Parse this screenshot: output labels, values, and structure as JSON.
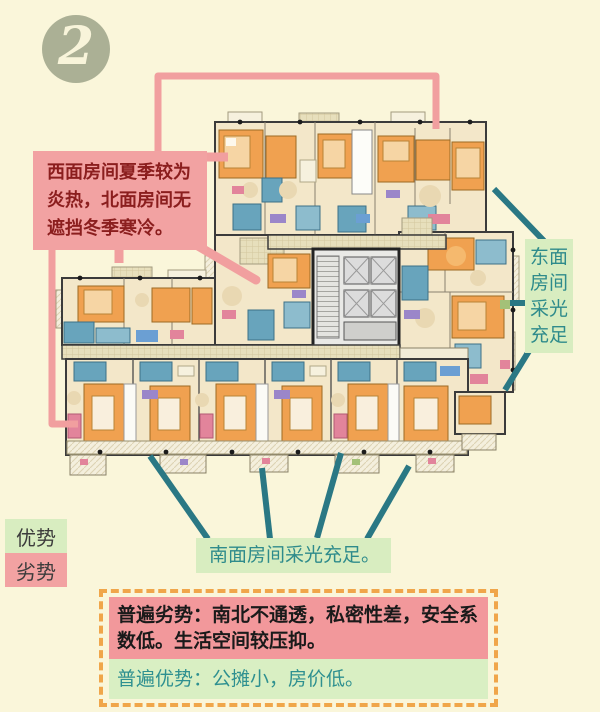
{
  "badge": {
    "number": "2"
  },
  "notes": {
    "west": "西面房间夏季较为炎热，北面房间无遮挡冬季寒冷。",
    "east": "东面房间采光充足",
    "south": "南面房间采光充足。"
  },
  "legend": {
    "advantage": "优势",
    "disadvantage": "劣势"
  },
  "summary": {
    "disadvantage": "普遍劣势：南北不通透，私密性差，安全系数低。生活空间较压抑。",
    "advantage": "普遍优势：公摊小，房价低。"
  },
  "colors": {
    "page_background": "#faf6da",
    "note_pink": "#f2a2a2",
    "note_pink_text": "#8b1e1e",
    "note_green": "#d8edc0",
    "teal_text": "#2e8b8b",
    "teal_line": "#2a7884",
    "pink_line": "#f19f9f",
    "dashed_border_orange": "#f0a64a",
    "summary_pink": "#f2989b",
    "summary_green": "#d9efc3",
    "badge_fill": "#abb095",
    "plan_orange": "#f0a150",
    "plan_cream": "#f3e7c9",
    "plan_blue": "#68a4bc"
  }
}
